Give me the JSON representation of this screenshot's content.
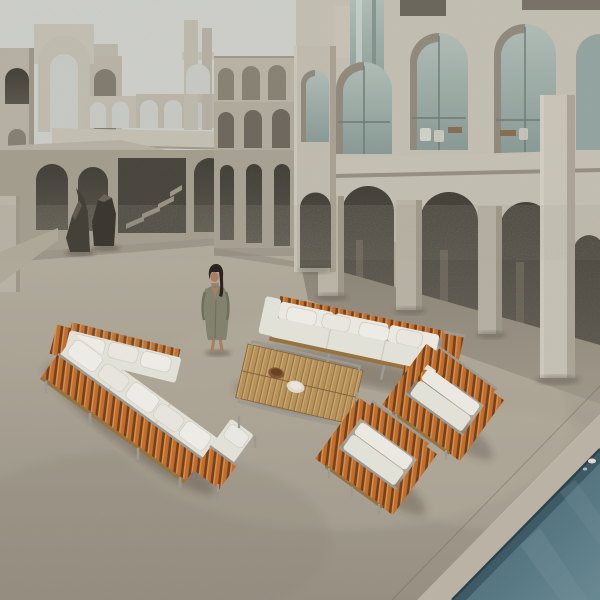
{
  "meta": {
    "type": "photograph",
    "description": "A woman in an olive wrap dress stands in a vast brutalist concrete courtyard of tiered arches and arcades. An outdoor lounge collection — an L-shaped sectional, a three-seat sofa and two armchairs, all with vertical iroko-teak slats, stainless frames and white cushions — surrounds a low slatted teak coffee table holding two small bowls. Two dark bronze sculptures stand by the left wall; a teal swimming pool cuts across the bottom-right corner."
  },
  "scene": {
    "sky": {
      "label": "overcast pale sky"
    },
    "architecture": {
      "left_label": "tiered concrete arch structures and ground arcade with staircase",
      "center_label": "stacked triple arcade connecting wing",
      "right_label": "two-storey loggia with glazed upper arches and tall open arcade",
      "pillar_label": "freestanding concrete pillar",
      "sculpture_label": "two dark bronze abstract sculptures"
    },
    "person": {
      "label": "woman in olive wrap dress",
      "pose": "standing, facing viewer, long dark hair"
    },
    "furniture": [
      {
        "label": "L-shaped sectional sofa",
        "materials": "teak slats, white cushions, steel frame"
      },
      {
        "label": "three-seat sofa",
        "materials": "white cushions, teak slat end panel"
      },
      {
        "label": "slatted teak coffee table",
        "items": "wooden bowl, cream bowl"
      },
      {
        "label": "slatted lounge armchair"
      },
      {
        "label": "slatted lounge armchair"
      }
    ],
    "pool": {
      "label": "swimming pool corner with stone coping"
    }
  },
  "colors": {
    "sky": "#d8dad6",
    "concrete_light": "#cfcabe",
    "concrete_mid": "#bcb6a9",
    "concrete_dark": "#a49d8f",
    "wall_shade": "#8f887a",
    "opening": "#5a554c",
    "opening_deep": "#403c35",
    "glass": "#bac8c3",
    "glass_dark": "#8ea29e",
    "ground": "#b3ab9c",
    "ground_light": "#c2baab",
    "ground_shadow": "#9c9486",
    "coping": "#c4bcae",
    "water": "#557886",
    "water_deep": "#3f5f6c",
    "water_light": "#6f909a",
    "waterline": "#2e454e",
    "slat": "#c9742f",
    "slat_light": "#e39a55",
    "slat_gap": "#7a431c",
    "cushion": "#efede5",
    "cushion_bright": "#f7f5ef",
    "cushion_shade": "#d8d4c8",
    "metal": "#a3a39d",
    "teak": "#c19a60",
    "teak_dark": "#9e7a45",
    "dish_wood": "#8a5a33",
    "dish_cream": "#ece6d8",
    "dress": "#8a8975",
    "hair": "#2c2621",
    "skin": "#b28566",
    "sculpture": "#48433b",
    "shadow": "rgba(70,60,45,0.32)"
  }
}
